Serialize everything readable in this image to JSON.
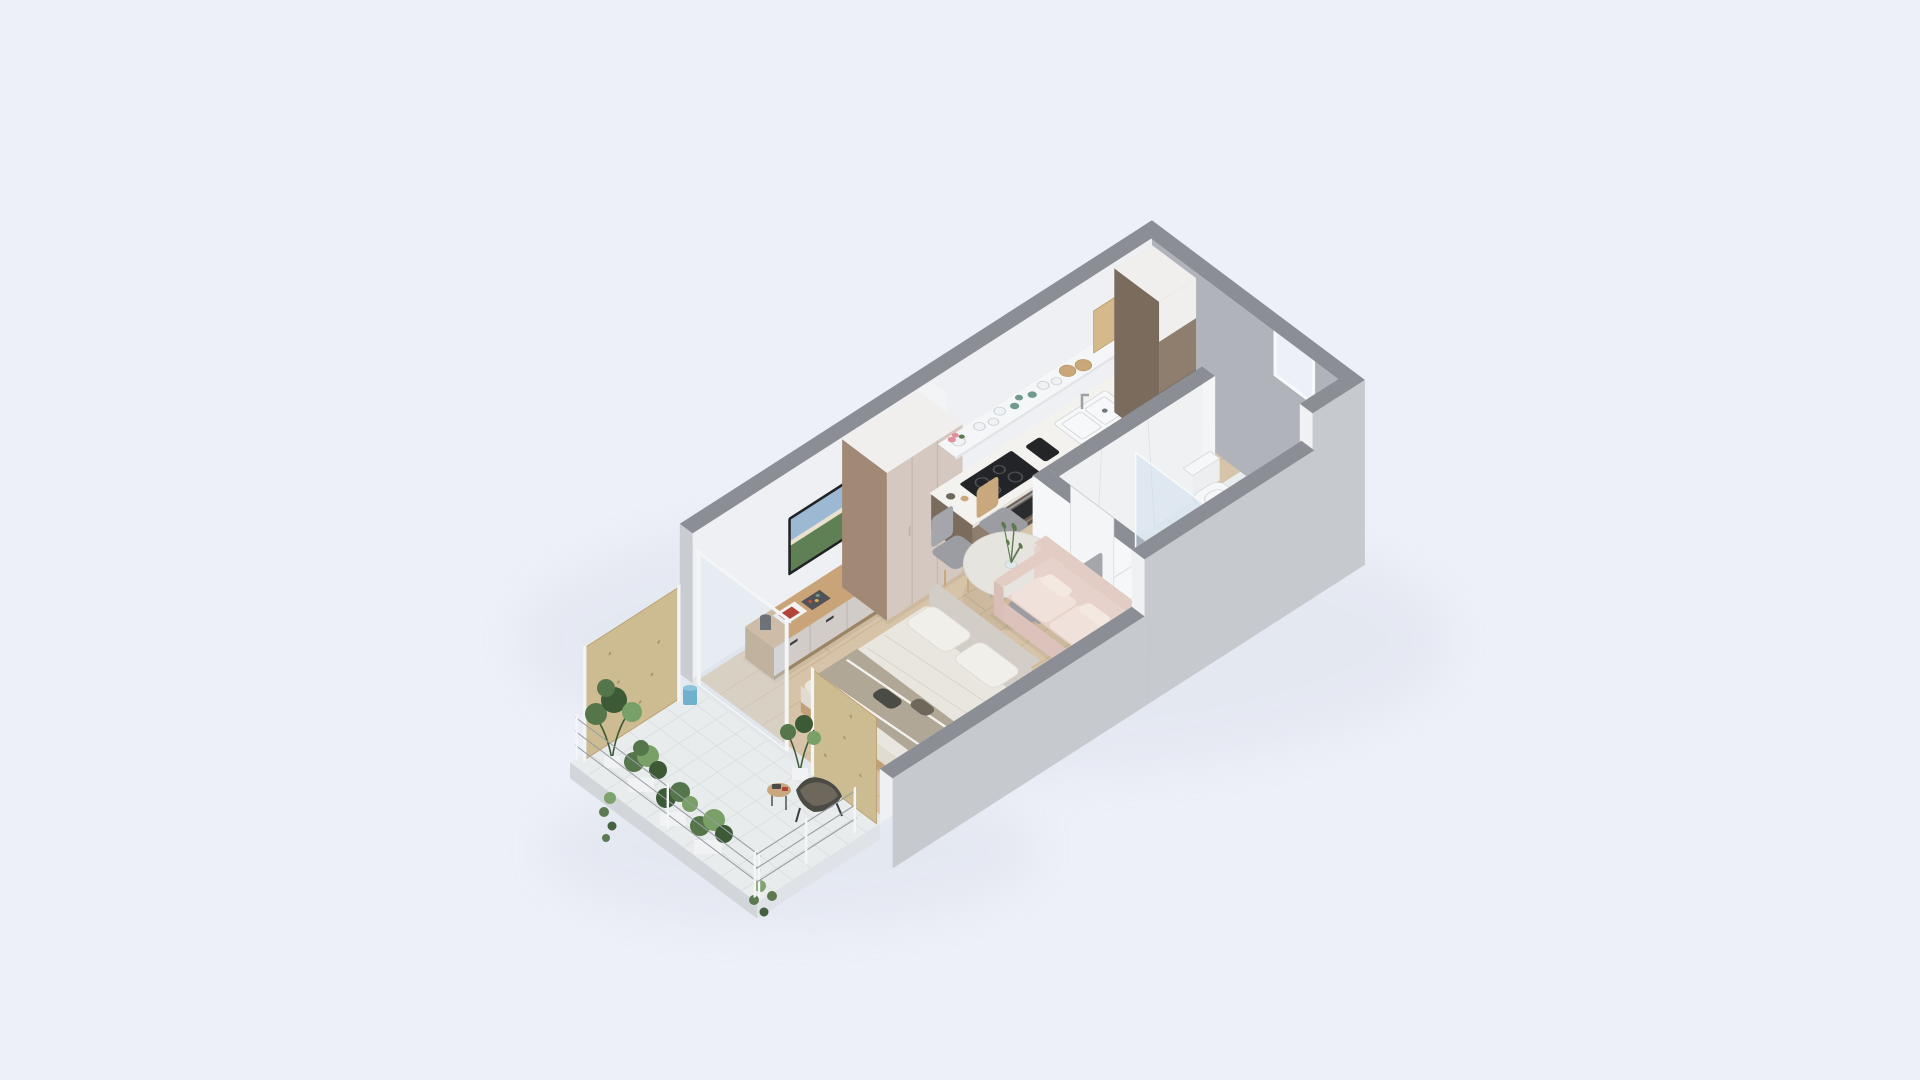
{
  "meta": {
    "description": "Isometric 3D cutaway floor plan render of a studio apartment",
    "canvas": {
      "width": 1920,
      "height": 1080
    }
  },
  "palette": {
    "bg": "#edf0f8",
    "groundShadow": "#96a0b4",
    "wallCap": "#8b8e94",
    "wallInner": "#eef0f3",
    "wallInnerLight": "#f6f7f9",
    "wallEnd": "#c9ccd1",
    "wallOuterFront": "#c6c9ce",
    "wallOuterSide": "#b0b4ba",
    "wood": "#d7c3a7",
    "woodLine": "#c6b091",
    "threshold": "#e4e7e9",
    "tile": "#e9eced",
    "tileLine": "#dcdfe2",
    "slabFront": "#dfe2e6",
    "slabLeft": "#d2d5d9",
    "marbleFloor": "#eaedef",
    "marbleWall": "#eff1f3",
    "marbleVein": "#d9dde0",
    "doorWhite": "#f4f5f7",
    "doorFrame": "#e2e4e7",
    "handle": "#73777c",
    "windowGlass": "#edf0f8",
    "windowFrame": "#f7f9fa",
    "counter": "#f3f2ef",
    "counterEdge": "#e5e3df",
    "cabinet": "#8f7e6e",
    "cabinetSide": "#7b6b5c",
    "toeKick": "#5e544b",
    "seam": "#74675a",
    "cooktop": "#222427",
    "ring": "#4a4e52",
    "ovenFrame": "#6b5d52",
    "ovenGlass": "#2a2c2f",
    "ovenHandle": "#9aa0a5",
    "sinkFill": "#f7f8f9",
    "sinkLine": "#d5d8db",
    "faucet": "#9aa0a5",
    "shelf": "#f5f6f8",
    "shelfEdge": "#e2e4e7",
    "glassItem": "#eef2f4",
    "glassLine": "#ccd2d6",
    "teal": "#6f9a8c",
    "woodPlate": "#c9a779",
    "board": "#d6b98a",
    "boardLine": "#bb9c6b",
    "toaster": "#232527",
    "flowerPink": "#e08f9b",
    "flowerGreen": "#5b7a4e",
    "leaf": "#55754a",
    "leafDark": "#3d5a36",
    "leafLight": "#79a066",
    "planter": "#f0f2f3",
    "osb": "#cdbb92",
    "osbDot": "#a9976e",
    "osbFrame": "#f2f4f5",
    "bluePot": "#6fb0cc",
    "bluePotTop": "#8cc4da",
    "railing": "#979da3",
    "wardrobeFront": "#d5c8c1",
    "wardrobeSeam": "#bfafa5",
    "wardrobeSide": "#a18976",
    "wardrobeTop": "#f0efed",
    "columnFront": "#f2f4f5",
    "columnSide": "#e3e5e8",
    "consoleTop": "#c9a478",
    "consoleFront": "#d1ccc8",
    "consoleSeam": "#b9b2ad",
    "consolePlinth": "#9c8566",
    "consoleSide": "#b2946f",
    "handleDark": "#3a3c3e",
    "tvFrame": "#202224",
    "tvSky": "#9cb8d2",
    "tvLand": "#5f7f54",
    "tvBeach": "#e9e2cf",
    "speaker": "#2b2d2f",
    "magazine": "#f2f2f0",
    "magazineRed": "#b24338",
    "tray": "#515356",
    "bedDuvet": "#e9e6df",
    "bedSide": "#e0dcd2",
    "bedFold": "#d6d1c5",
    "frameWood": "#c2a077",
    "pillow": "#f1efe9",
    "pillowLine": "#dfdcd4",
    "blanket": "#b1a797",
    "stripe": "#f4f2ec",
    "darkItem": "#4b4b45",
    "darkItem2": "#6e675c",
    "headboard": "#d2cec7",
    "tableTop": "#e6e4df",
    "tableEdge": "#d8d6d1",
    "tableLeg": "#b3aea7",
    "chairSeat": "#9b9da2",
    "chairBack": "#a4a6ab",
    "chairWood": "#c8a87c",
    "vase": "#dfe8ea",
    "sprig": "#5b7a4e",
    "sofaBody": "#e7d2cb",
    "sofaFront": "#dcc2ba",
    "sofaCushion": "#f0e1da",
    "sofaArm": "#e3ccc4",
    "sofaArmSide": "#d9bfb7",
    "sofaPillow": "#f4e8e2",
    "fixture": "#f6f7f9",
    "fixtureShade": "#eceef0",
    "fixtureLine": "#d8dbde",
    "glassScreen": "rgba(205,222,238,0.45)",
    "doorGlass": "rgba(218,230,242,0.38)",
    "panelWhite": "#f3f5f6",
    "furnShadow": "rgba(110,95,75,0.10)",
    "wallShade": "rgba(90,95,105,0.07)"
  },
  "scene": {
    "style": "isometric cutaway apartment render",
    "rooms": [
      {
        "name": "balcony",
        "items": [
          "osb-privacy-panel",
          "osb-divider-panel",
          "wire-railing",
          "potted-plants",
          "hanging-vines",
          "blue-pot",
          "butterfly-chair",
          "side-table",
          "white-tile-floor"
        ]
      },
      {
        "name": "living-sleeping-area",
        "items": [
          "double-bed",
          "pillows",
          "throw-blanket",
          "headboard",
          "tv",
          "tv-console",
          "speaker",
          "magazines",
          "remote-tray",
          "wardrobe",
          "sliding-glass-door",
          "wood-floor"
        ]
      },
      {
        "name": "dining-area",
        "items": [
          "round-table",
          "four-chairs",
          "vase-with-branches"
        ]
      },
      {
        "name": "kitchen",
        "items": [
          "base-cabinets",
          "countertop",
          "induction-cooktop",
          "oven",
          "sink",
          "faucet",
          "toaster",
          "open-shelf",
          "glasses",
          "teal-cups",
          "wooden-plates",
          "cutting-board",
          "flower-pot",
          "tall-cabinet",
          "service-column"
        ]
      },
      {
        "name": "bathroom",
        "items": [
          "marble-walls",
          "marble-floor",
          "shower-tray",
          "glass-screen",
          "white-panel",
          "washbasin",
          "toilet",
          "window"
        ]
      },
      {
        "name": "entry",
        "items": [
          "entrance-door",
          "hallway-wood-floor"
        ]
      }
    ]
  }
}
